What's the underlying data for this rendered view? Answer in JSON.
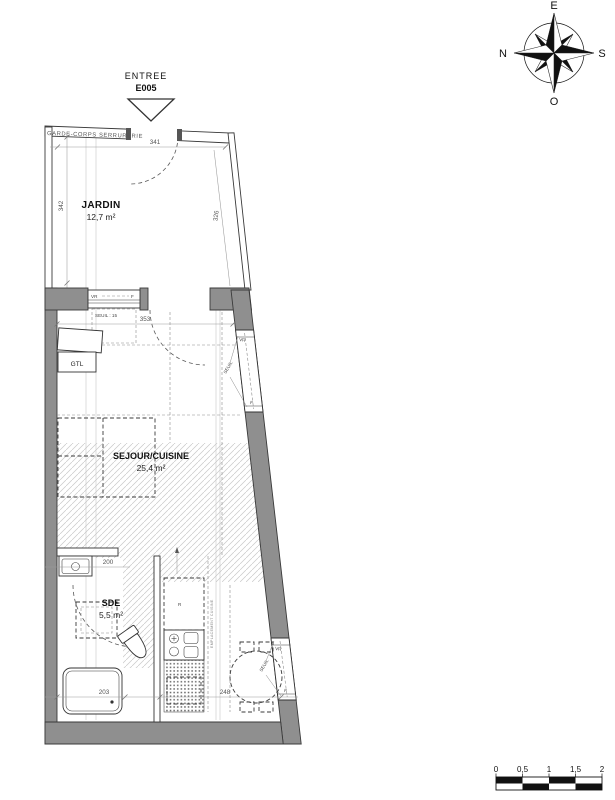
{
  "compass": {
    "e": "E",
    "n": "N",
    "s": "S",
    "o": "O"
  },
  "entrance": {
    "label": "ENTREE",
    "code": "E005"
  },
  "rooms": {
    "jardin": {
      "name": "JARDIN",
      "area": "12,7 m²"
    },
    "sejour": {
      "name": "SEJOUR/CUISINE",
      "area": "25,4 m²"
    },
    "sde": {
      "name": "SDE",
      "area": "5,5 m²"
    }
  },
  "annotations": {
    "garde_corps": "GARDE-CORPS SERRURERIE",
    "gtl": "GTL",
    "seuil_15": "SEUIL : 15",
    "seuil": "SEUIL",
    "vr": "VR",
    "f": "F",
    "fridge": "R",
    "kitchen_note": "EMPLACEMENT CUISINE"
  },
  "dimensions": {
    "jardin_width": "341",
    "jardin_height": "342",
    "jardin_slant": "326",
    "sejour_width": "353",
    "sde_width": "200",
    "shower_width": "203",
    "dining_width": "248"
  },
  "scale_bar": {
    "ticks": [
      "0",
      "0,5",
      "1",
      "1,5",
      "2"
    ]
  },
  "colors": {
    "wall_fill": "#8f8f8f",
    "line": "#3a3a3a",
    "hatch": "#c9c9c9"
  }
}
